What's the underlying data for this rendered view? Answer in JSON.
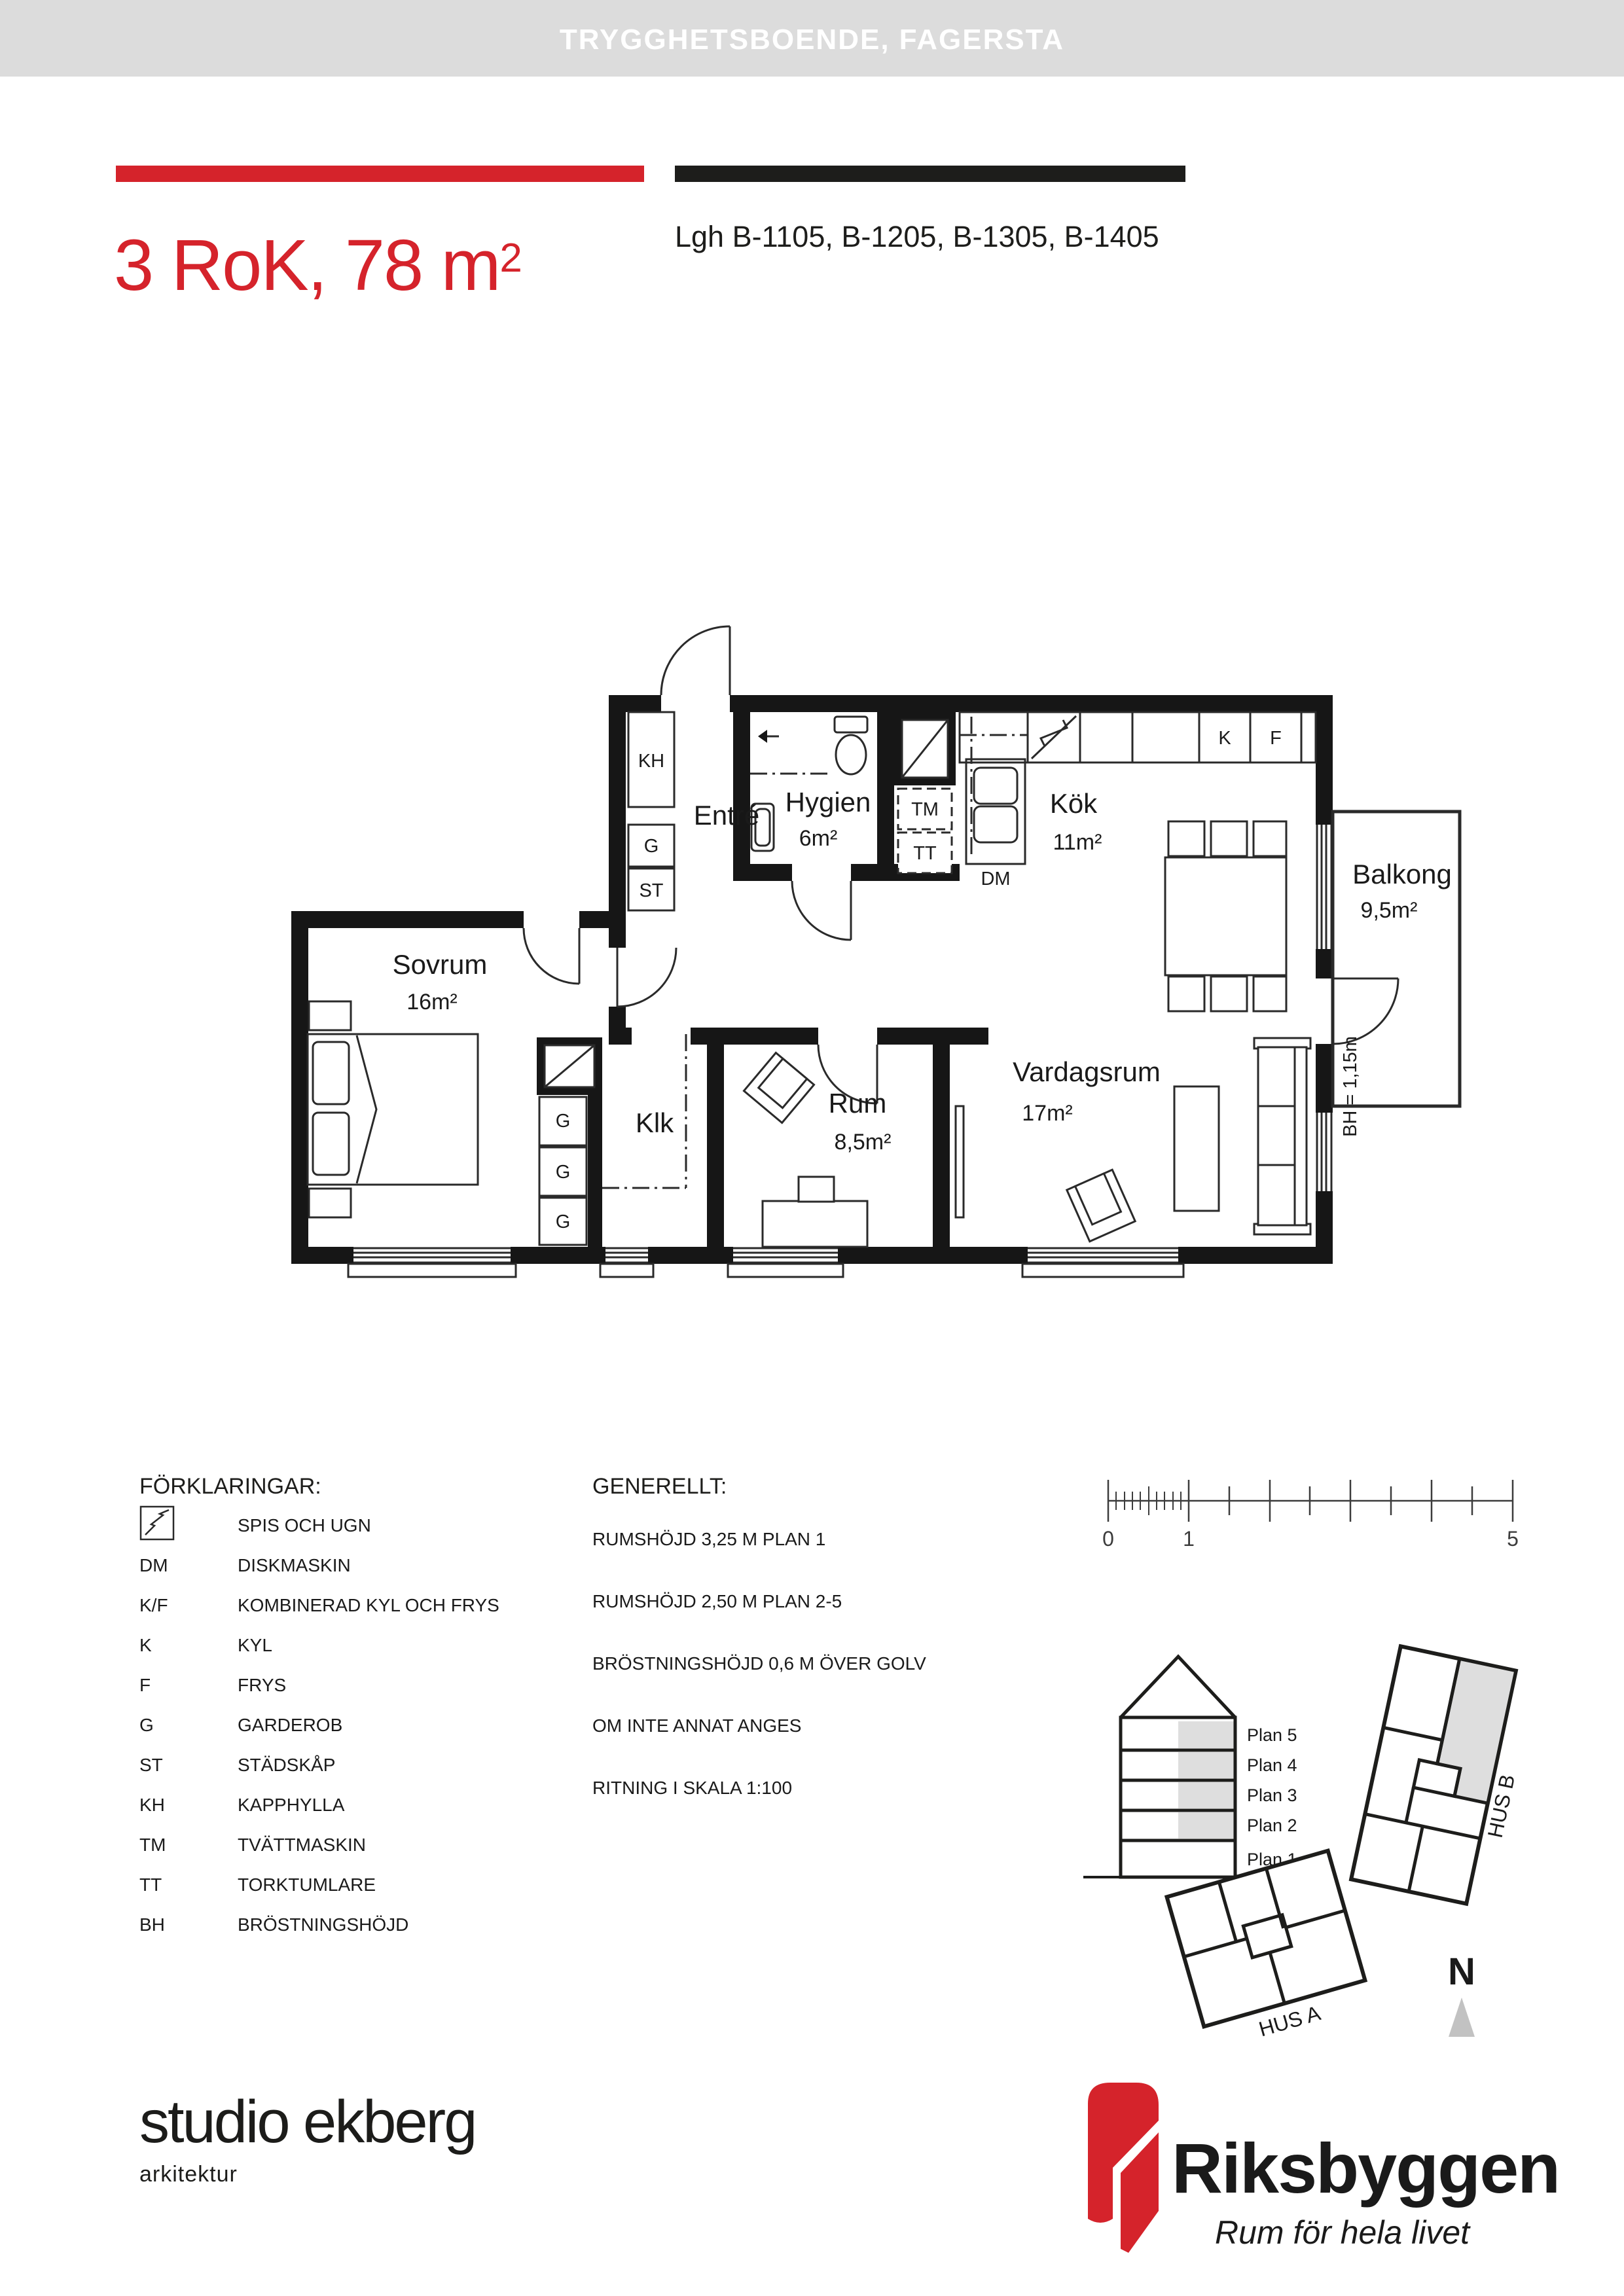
{
  "header": {
    "title": "TRYGGHETSBOENDE, FAGERSTA"
  },
  "title_block": {
    "title_main": "3 RoK, 78 m",
    "title_sup": "2",
    "apartments": "Lgh B-1105, B-1205, B-1305, B-1405"
  },
  "floor_plan": {
    "rooms": {
      "entre": {
        "name": "Entré"
      },
      "hygien": {
        "name": "Hygien",
        "area": "6m²"
      },
      "kok": {
        "name": "Kök",
        "area": "11m²"
      },
      "balkong": {
        "name": "Balkong",
        "area": "9,5m²"
      },
      "sovrum": {
        "name": "Sovrum",
        "area": "16m²"
      },
      "klk": {
        "name": "Klk"
      },
      "rum": {
        "name": "Rum",
        "area": "8,5m²"
      },
      "vardagsrum": {
        "name": "Vardagsrum",
        "area": "17m²"
      }
    },
    "fixtures": {
      "kh": "KH",
      "g": "G",
      "st": "ST",
      "tm": "TM",
      "tt": "TT",
      "dm": "DM",
      "k": "K",
      "f": "F"
    },
    "bh_note": "BH = 1,15m"
  },
  "legend": {
    "title": "FÖRKLARINGAR:",
    "items": [
      {
        "code": "",
        "desc": "SPIS OCH UGN"
      },
      {
        "code": "DM",
        "desc": "DISKMASKIN"
      },
      {
        "code": "K/F",
        "desc": "KOMBINERAD KYL OCH FRYS"
      },
      {
        "code": "K",
        "desc": "KYL"
      },
      {
        "code": "F",
        "desc": "FRYS"
      },
      {
        "code": "G",
        "desc": "GARDEROB"
      },
      {
        "code": "ST",
        "desc": "STÄDSKÅP"
      },
      {
        "code": "KH",
        "desc": "KAPPHYLLA"
      },
      {
        "code": "TM",
        "desc": "TVÄTTMASKIN"
      },
      {
        "code": "TT",
        "desc": "TORKTUMLARE"
      },
      {
        "code": "BH",
        "desc": "BRÖSTNINGSHÖJD"
      }
    ]
  },
  "generellt": {
    "title": "GENERELLT:",
    "lines": [
      "RUMSHÖJD 3,25 M PLAN 1",
      "RUMSHÖJD 2,50 M PLAN 2-5",
      "BRÖSTNINGSHÖJD 0,6 M ÖVER GOLV",
      "OM INTE ANNAT ANGES",
      "RITNING I SKALA 1:100"
    ]
  },
  "scale_bar": {
    "zero": "0",
    "one": "1",
    "five": "5"
  },
  "elevation": {
    "floors": [
      "Plan 5",
      "Plan 4",
      "Plan 3",
      "Plan 2",
      "Plan 1"
    ]
  },
  "site": {
    "hus_a": "HUS A",
    "hus_b": "HUS B",
    "north": "N"
  },
  "footer": {
    "studio_name": "studio ekberg",
    "studio_sub": "arkitektur",
    "brand_name": "Riksbyggen",
    "brand_tagline": "Rum för hela livet"
  },
  "colors": {
    "accent_red": "#d5232b",
    "header_gray": "#dcdcdc",
    "logo_gray": "#9b9da0",
    "diagram_gray": "#dedede"
  }
}
